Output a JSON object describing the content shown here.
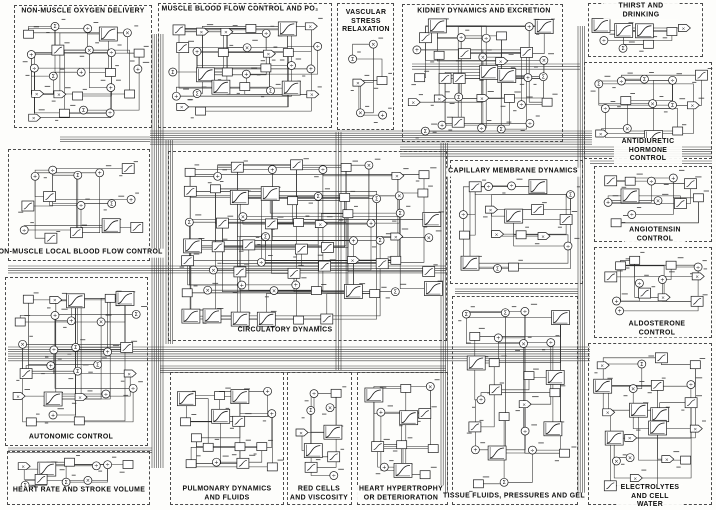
{
  "figure": {
    "kind": "systems-analysis block diagram (scanned, black line art on white)",
    "width": 716,
    "height": 510,
    "ink": "#1c1c1c",
    "paper": "#fdfdfb",
    "border": "#4a4a4a",
    "wire": "#2a2a2a"
  },
  "node_symbols": [
    "×",
    "+",
    "÷",
    "Σ"
  ],
  "sections": [
    {
      "id": "non-muscle-oxygen-delivery",
      "title": "NON-MUSCLE  OXYGEN  DELIVERY",
      "box": [
        14,
        5,
        138,
        123
      ],
      "title_side": "top",
      "title_center": [
        83,
        12
      ],
      "nodes": 24,
      "seed": 101
    },
    {
      "id": "muscle-blood-flow-control",
      "title": "MUSCLE BLOOD FLOW CONTROL AND PO₂",
      "box": [
        158,
        3,
        174,
        125
      ],
      "title_side": "top",
      "title_center": [
        240,
        10
      ],
      "nodes": 30,
      "seed": 102
    },
    {
      "id": "vascular-stress-relaxation",
      "title": "VASCULAR\nSTRESS\nRELAXATION",
      "box": [
        337,
        3,
        57,
        127
      ],
      "title_side": "top",
      "title_center": [
        366,
        22
      ],
      "nodes": 6,
      "seed": 103
    },
    {
      "id": "kidney-dynamics-and-excretion",
      "title": "KIDNEY  DYNAMICS  AND  EXCRETION",
      "box": [
        402,
        4,
        161,
        138
      ],
      "title_side": "top",
      "title_center": [
        484,
        12
      ],
      "nodes": 34,
      "seed": 104
    },
    {
      "id": "thirst-and-drinking",
      "title": "THIRST  AND  DRINKING",
      "box": [
        588,
        3,
        115,
        54
      ],
      "title_side": "top",
      "title_center": [
        641,
        11
      ],
      "nodes": 8,
      "seed": 105
    },
    {
      "id": "antidiuretic-hormone-control",
      "title": "ANTIDIURETIC  HORMONE  CONTROL",
      "box": [
        584,
        62,
        128,
        97
      ],
      "title_side": "bottom",
      "title_center": [
        648,
        151
      ],
      "nodes": 14,
      "seed": 106
    },
    {
      "id": "capillary-membrane-dynamics",
      "title": "CAPILLARY  MEMBRANE  DYNAMICS",
      "box": [
        450,
        160,
        133,
        124
      ],
      "title_side": "top",
      "title_center": [
        513,
        172
      ],
      "nodes": 18,
      "seed": 107
    },
    {
      "id": "angiotensin-control",
      "title": "ANGIOTENSIN  CONTROL",
      "box": [
        594,
        166,
        118,
        76
      ],
      "title_side": "bottom",
      "title_center": [
        655,
        235
      ],
      "nodes": 12,
      "seed": 108
    },
    {
      "id": "aldosterone-control",
      "title": "ALDOSTERONE  CONTROL",
      "box": [
        594,
        247,
        118,
        91
      ],
      "title_side": "bottom",
      "title_center": [
        657,
        329
      ],
      "nodes": 13,
      "seed": 109
    },
    {
      "id": "electrolytes-and-cell-water",
      "title": "ELECTROLYTES  AND  CELL  WATER",
      "box": [
        588,
        343,
        124,
        162
      ],
      "title_side": "bottom",
      "title_center": [
        650,
        497
      ],
      "nodes": 22,
      "seed": 110
    },
    {
      "id": "non-muscle-local-blood-flow-control",
      "title": "NON-MUSCLE  LOCAL  BLOOD  FLOW  CONTROL",
      "box": [
        8,
        149,
        142,
        112
      ],
      "title_side": "bottom",
      "title_center": [
        78,
        253
      ],
      "nodes": 15,
      "seed": 111
    },
    {
      "id": "circulatory-dynamics",
      "title": "CIRCULATORY  DYNAMICS",
      "box": [
        168,
        151,
        279,
        190
      ],
      "title_side": "bottom",
      "title_center": [
        285,
        331
      ],
      "nodes": 66,
      "seed": 112
    },
    {
      "id": "autonomic-control",
      "title": "AUTONOMIC  CONTROL",
      "box": [
        5,
        277,
        143,
        169
      ],
      "title_side": "bottom",
      "title_center": [
        71,
        438
      ],
      "nodes": 28,
      "seed": 113
    },
    {
      "id": "heart-rate-and-stroke-volume",
      "title": "HEART  RATE  AND  STROKE  VOLUME",
      "box": [
        7,
        451,
        143,
        54
      ],
      "title_side": "bottom",
      "title_center": [
        79,
        491
      ],
      "nodes": 10,
      "seed": 114
    },
    {
      "id": "pulmonary-dynamics-and-fluids",
      "title": "PULMONARY  DYNAMICS\nAND  FLUIDS",
      "box": [
        170,
        372,
        114,
        133
      ],
      "title_side": "bottom",
      "title_center": [
        227,
        494
      ],
      "nodes": 16,
      "seed": 115
    },
    {
      "id": "red-cells-and-viscosity",
      "title": "RED  CELLS\nAND  VISCOSITY",
      "box": [
        287,
        372,
        65,
        133
      ],
      "title_side": "bottom",
      "title_center": [
        319,
        494
      ],
      "nodes": 10,
      "seed": 116
    },
    {
      "id": "heart-hypertrophy-or-deterioration",
      "title": "HEART  HYPERTROPHY\nOR  DETERIORATION",
      "box": [
        357,
        372,
        91,
        133
      ],
      "title_side": "bottom",
      "title_center": [
        401,
        494
      ],
      "nodes": 12,
      "seed": 117
    },
    {
      "id": "tissue-fluids-pressures-and-gel",
      "title": "TISSUE  FLUIDS, PRESSURES  AND  GEL",
      "box": [
        452,
        296,
        126,
        209
      ],
      "title_side": "bottom",
      "title_center": [
        514,
        497
      ],
      "nodes": 26,
      "seed": 118
    }
  ],
  "buses": [
    {
      "pts": [
        [
          150,
          131
        ],
        [
          592,
          131
        ]
      ],
      "n": 7,
      "gap": 2.2,
      "dir": "h"
    },
    {
      "pts": [
        [
          400,
          147
        ],
        [
          712,
          147
        ]
      ],
      "n": 5,
      "gap": 2.3,
      "dir": "h"
    },
    {
      "pts": [
        [
          152,
          34
        ],
        [
          152,
          468
        ]
      ],
      "n": 6,
      "gap": 2.2,
      "dir": "v"
    },
    {
      "pts": [
        [
          8,
          347
        ],
        [
          590,
          347
        ]
      ],
      "n": 7,
      "gap": 2.3,
      "dir": "h"
    },
    {
      "pts": [
        [
          441,
          143
        ],
        [
          441,
          498
        ]
      ],
      "n": 4,
      "gap": 2.2,
      "dir": "v"
    },
    {
      "pts": [
        [
          578,
          26
        ],
        [
          578,
          500
        ]
      ],
      "n": 4,
      "gap": 2.2,
      "dir": "v"
    },
    {
      "pts": [
        [
          412,
          64
        ],
        [
          580,
          64
        ]
      ],
      "n": 3,
      "gap": 2.6,
      "dir": "h"
    },
    {
      "pts": [
        [
          8,
          266
        ],
        [
          446,
          266
        ]
      ],
      "n": 4,
      "gap": 2.3,
      "dir": "h"
    },
    {
      "pts": [
        [
          8,
          448
        ],
        [
          152,
          448
        ]
      ],
      "n": 3,
      "gap": 2.2,
      "dir": "h"
    },
    {
      "pts": [
        [
          336,
          132
        ],
        [
          336,
          370
        ]
      ],
      "n": 3,
      "gap": 2.5,
      "dir": "v"
    },
    {
      "pts": [
        [
          160,
          366
        ],
        [
          446,
          366
        ]
      ],
      "n": 4,
      "gap": 2.2,
      "dir": "h"
    },
    {
      "pts": [
        [
          590,
          161
        ],
        [
          712,
          161
        ]
      ],
      "n": 2,
      "gap": 2.6,
      "dir": "h"
    },
    {
      "pts": [
        [
          166,
          140
        ],
        [
          166,
          344
        ]
      ],
      "n": 4,
      "gap": 2.2,
      "dir": "v"
    },
    {
      "pts": [
        [
          455,
          289
        ],
        [
          578,
          289
        ]
      ],
      "n": 3,
      "gap": 2.3,
      "dir": "h"
    },
    {
      "pts": [
        [
          60,
          137
        ],
        [
          150,
          137
        ]
      ],
      "n": 3,
      "gap": 2.2,
      "dir": "h"
    }
  ]
}
